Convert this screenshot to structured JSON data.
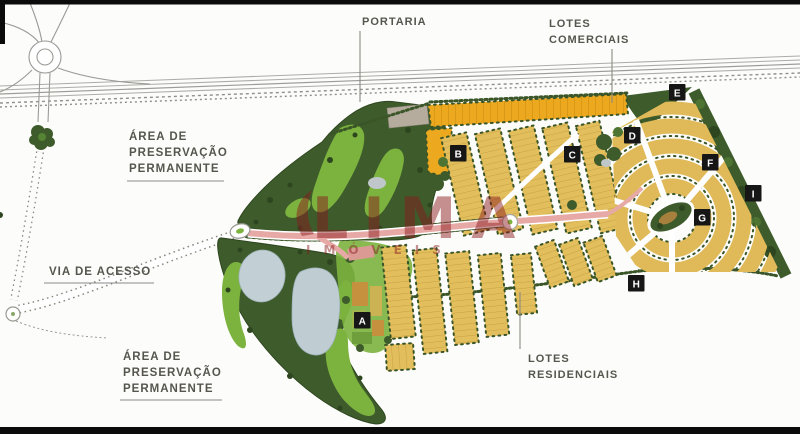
{
  "image_type": "condominium masterplan site map",
  "labels": {
    "portaria": "PORTARIA",
    "lotes_comerciais": [
      "LOTES",
      "COMERCIAIS"
    ],
    "preservacao_upper": [
      "ÁREA DE",
      "PRESERVAÇÃO",
      "PERMANENTE"
    ],
    "via_de_acesso": "VIA DE ACESSO",
    "preservacao_lower": [
      "ÁREA DE",
      "PRESERVAÇÃO",
      "PERMANENTE"
    ],
    "lotes_residenciais": [
      "LOTES",
      "RESIDENCIAIS"
    ]
  },
  "markers": [
    "A",
    "B",
    "C",
    "D",
    "E",
    "F",
    "G",
    "H",
    "I"
  ],
  "watermark": {
    "brand": "LIMA",
    "subtitle": "IMÓVEIS"
  },
  "colors": {
    "residential_lot": "#E3BE5D",
    "commercial_lot": "#ECA81F",
    "preservation_dark": "#3E5B2B",
    "preservation_light": "#7CB23E",
    "water": "#BFCDD3",
    "road_pink": "#E7A9A6",
    "marker_bg": "#161616",
    "label_text": "#56564F",
    "watermark_red": "#8B1A1E"
  }
}
